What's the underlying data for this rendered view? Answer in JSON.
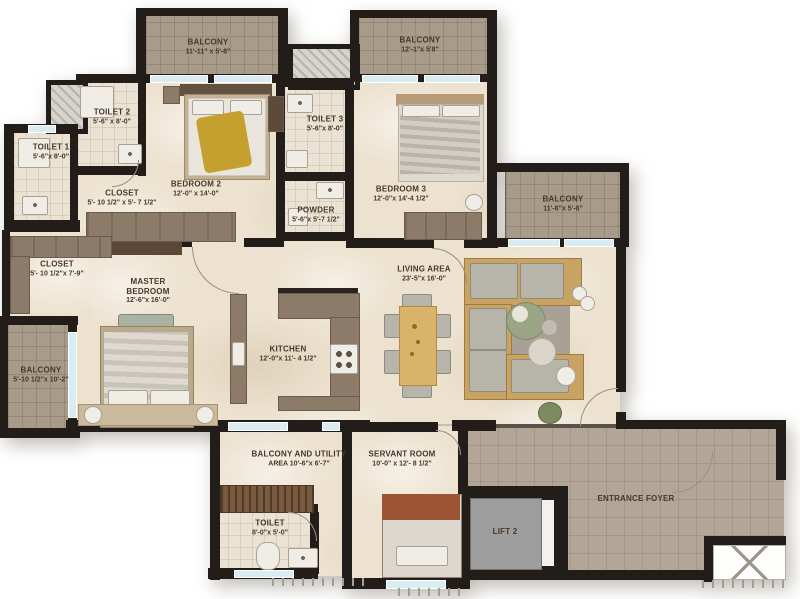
{
  "plan": {
    "rooms": [
      {
        "id": "balcony-top-left",
        "name": "BALCONY",
        "dims": "11'-11\" x 5'-8\""
      },
      {
        "id": "balcony-top-right",
        "name": "BALCONY",
        "dims": "12'-1\"x 5'8\""
      },
      {
        "id": "toilet-2",
        "name": "TOILET 2",
        "dims": "5'-6\" x 8'-0\""
      },
      {
        "id": "toilet-1",
        "name": "TOILET 1",
        "dims": "5'-6\"x 8'-0\""
      },
      {
        "id": "closet-1",
        "name": "CLOSET",
        "dims": "5'- 10 1/2\" x 5'- 7 1/2\""
      },
      {
        "id": "bedroom-2",
        "name": "BEDROOM 2",
        "dims": "12'-0\" x 14'-0\""
      },
      {
        "id": "toilet-3",
        "name": "TOILET 3",
        "dims": "5'-6\"x 8'-0\""
      },
      {
        "id": "powder",
        "name": "POWDER",
        "dims": "5'-6\"x 5'-7 1/2\""
      },
      {
        "id": "bedroom-3",
        "name": "BEDROOM 3",
        "dims": "12'-0\"x 14'-4 1/2\""
      },
      {
        "id": "balcony-right",
        "name": "BALCONY",
        "dims": "11'-8\"x 5'-8\""
      },
      {
        "id": "closet-2",
        "name": "CLOSET",
        "dims": "5'- 10 1/2\"x 7'-9\""
      },
      {
        "id": "master-bedroom",
        "name": "MASTER BEDROOM",
        "dims": "12'-6\"x 16'-0\""
      },
      {
        "id": "balcony-left",
        "name": "BALCONY",
        "dims": "5'-10 1/2\"x 10'-2\""
      },
      {
        "id": "kitchen",
        "name": "KITCHEN",
        "dims": "12'-0\"x 11'- 4 1/2\""
      },
      {
        "id": "living-area",
        "name": "LIVING AREA",
        "dims": "23'-5\"x 16'-0\""
      },
      {
        "id": "balcony-utility",
        "name": "BALCONY AND UTILITY",
        "dims": "AREA  10'-6\"x 6'-7\""
      },
      {
        "id": "servant-room",
        "name": "SERVANT ROOM",
        "dims": "10'-0\" x 12'- 8 1/2\""
      },
      {
        "id": "toilet-bottom",
        "name": "TOILET",
        "dims": "8'-0\"x 5'-0\""
      },
      {
        "id": "lift-2",
        "name": "LIFT 2",
        "dims": ""
      },
      {
        "id": "entrance-foyer",
        "name": "ENTRANCE FOYER",
        "dims": ""
      }
    ],
    "colors": {
      "wall": "#221d18",
      "marble_floor": "#ece2cf",
      "balcony_tile": "#a99b8a",
      "foyer_tile": "#b3a696",
      "window_glass": "#d8ecf2",
      "counter_brown": "#8d7b69",
      "sofa_wood": "#c9a361",
      "bed_throw_yellow": "#c5a02f",
      "servant_blanket": "#9c5434",
      "lift_gray": "#9d9d9d",
      "label_text": "#46392a"
    }
  }
}
